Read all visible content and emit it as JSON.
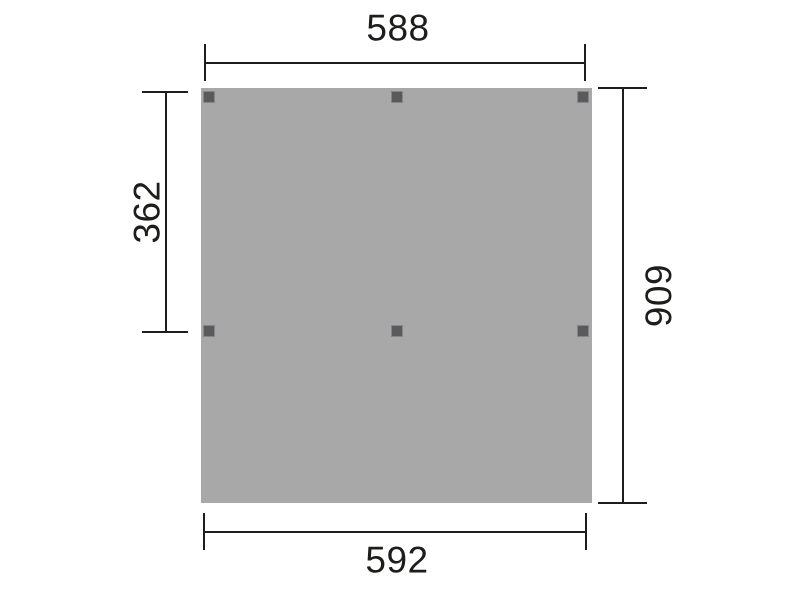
{
  "diagram": {
    "type": "technical-plan-drawing",
    "description": "Top view plan of a rectangular panel with six post markers and four dimension lines",
    "dimensions": {
      "top": "588",
      "bottom": "592",
      "left": "362",
      "right": "606"
    },
    "posts_count": 6,
    "colors": {
      "panel": "#a8a8a8",
      "post": "#5a5a5c",
      "line": "#1d1d1b",
      "background": "#ffffff"
    }
  }
}
